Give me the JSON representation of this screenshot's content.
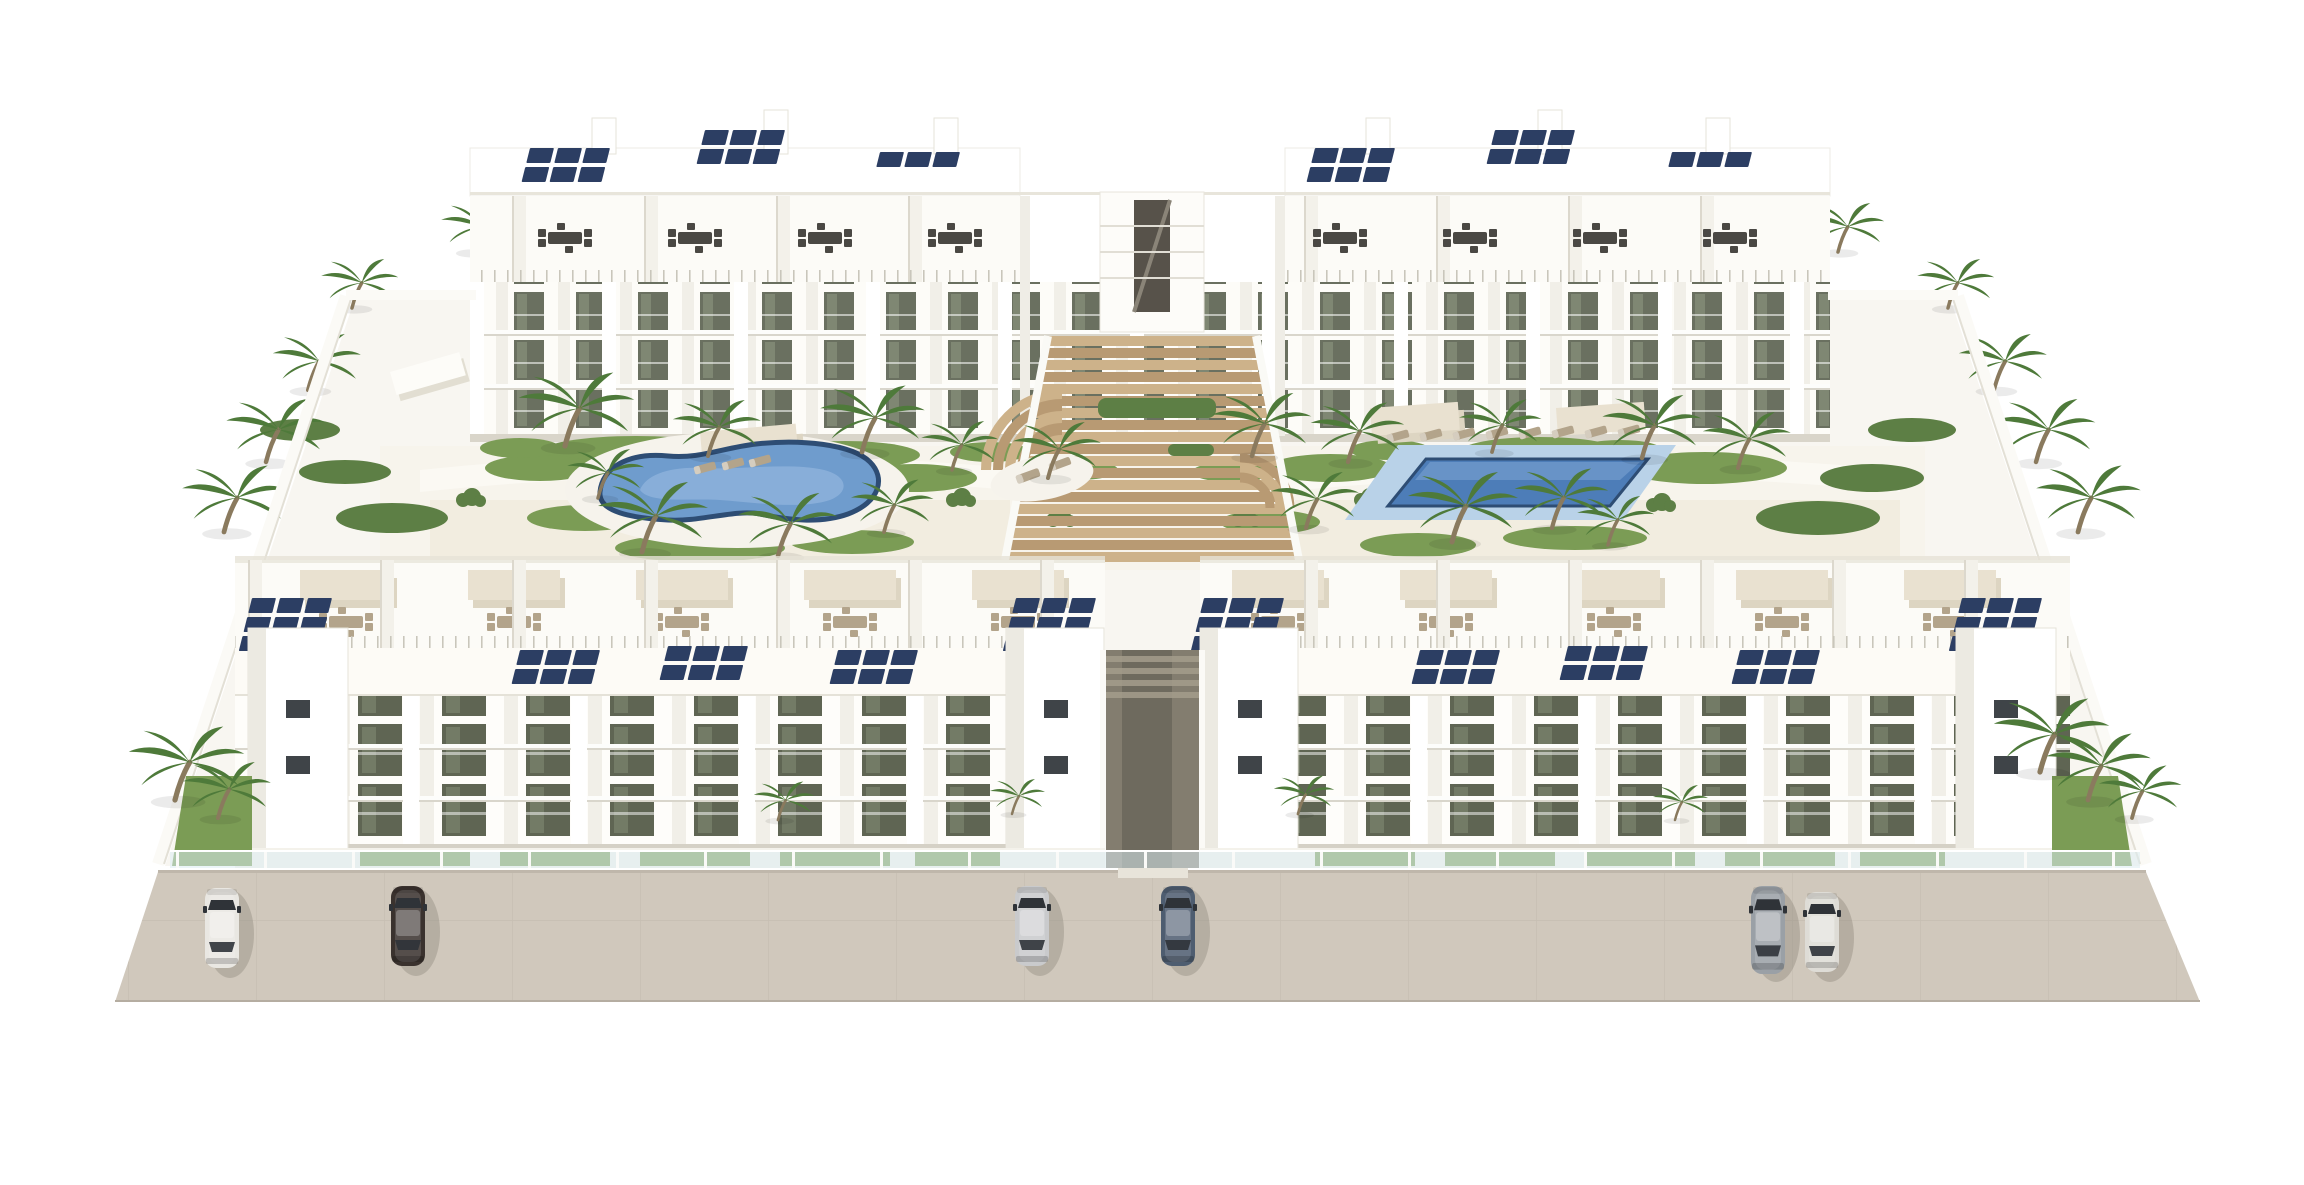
{
  "scene": {
    "title": "Aerial render - white apartment complex",
    "description": "High-angle aerial 3D architectural rendering of a white modern residential complex: two rear apartment blocks and two front apartment blocks with rooftop terraces, pergolas, dining sets and dark-blue solar panels, a central wooden stepped walkway, a kidney-shaped pool and a rectangular pool in palm-tree gardens, glass balustrades and a beige street with six parked cars",
    "view": "isometric aerial",
    "background": "#ffffff"
  },
  "colors": {
    "site": "#f8f6f1",
    "building_white": "#ffffff",
    "building_cream": "#fcfbf7",
    "building_shade": "#eceae2",
    "slab_shadow": "#d9d6cc",
    "window_glass_back": "#6a7060",
    "window_glass_front": "#5f6553",
    "solar_panel": "#2c3e63",
    "wood_light": "#cdb28a",
    "wood_dark": "#b89a73",
    "pool_rim": "#2e4d74",
    "pool_water": "#6f9ccd",
    "pool_water_light": "#8fb3dc",
    "pool_deck": "#f6f3ec",
    "rect_pool_deck": "#b9d2e8",
    "rect_pool_water": "#4d7db8",
    "grass": "#7b9c55",
    "grass_dark": "#5d7f45",
    "palm_frond": "#4e7a3a",
    "palm_trunk": "#8a7a5e",
    "sand_path": "#efe9dc",
    "promenade": "#fbf9f3",
    "pergola": "#e9e1d0",
    "pergola_shadow": "#ddd5c2",
    "furniture_dark": "#4a4844",
    "furniture_light": "#b3a48b",
    "alley": "#837d6f",
    "street": "#d0c8bc",
    "street_line": "#c3bbaf",
    "curb": "#bfb7ab",
    "glass_balustrade": "#dcecf2",
    "car_glass": "#2f3338"
  },
  "inventory": {
    "apartment_blocks": 4,
    "floors_visible": 3,
    "swimming_pools": 2,
    "pool_left_shape": "kidney",
    "pool_right_shape": "rectangular",
    "solar_arrays": 16,
    "palm_trees": 37,
    "parked_cars": 6,
    "sun_loungers": 13,
    "rooftop_dining_sets": 18,
    "pergolas": 13,
    "car_colors_left_to_right": [
      "white",
      "black",
      "silver",
      "slate-blue",
      "gray",
      "white"
    ]
  },
  "cars": [
    {
      "name": "white-hatchback",
      "color": "#e9e7e2"
    },
    {
      "name": "black-sedan",
      "color": "#3a322e"
    },
    {
      "name": "silver-sedan",
      "color": "#c9cacc"
    },
    {
      "name": "slate-blue-suv",
      "color": "#4e5d70"
    },
    {
      "name": "gray-minivan",
      "color": "#9aa0a6"
    },
    {
      "name": "white-sedan",
      "color": "#dedcd6"
    }
  ]
}
